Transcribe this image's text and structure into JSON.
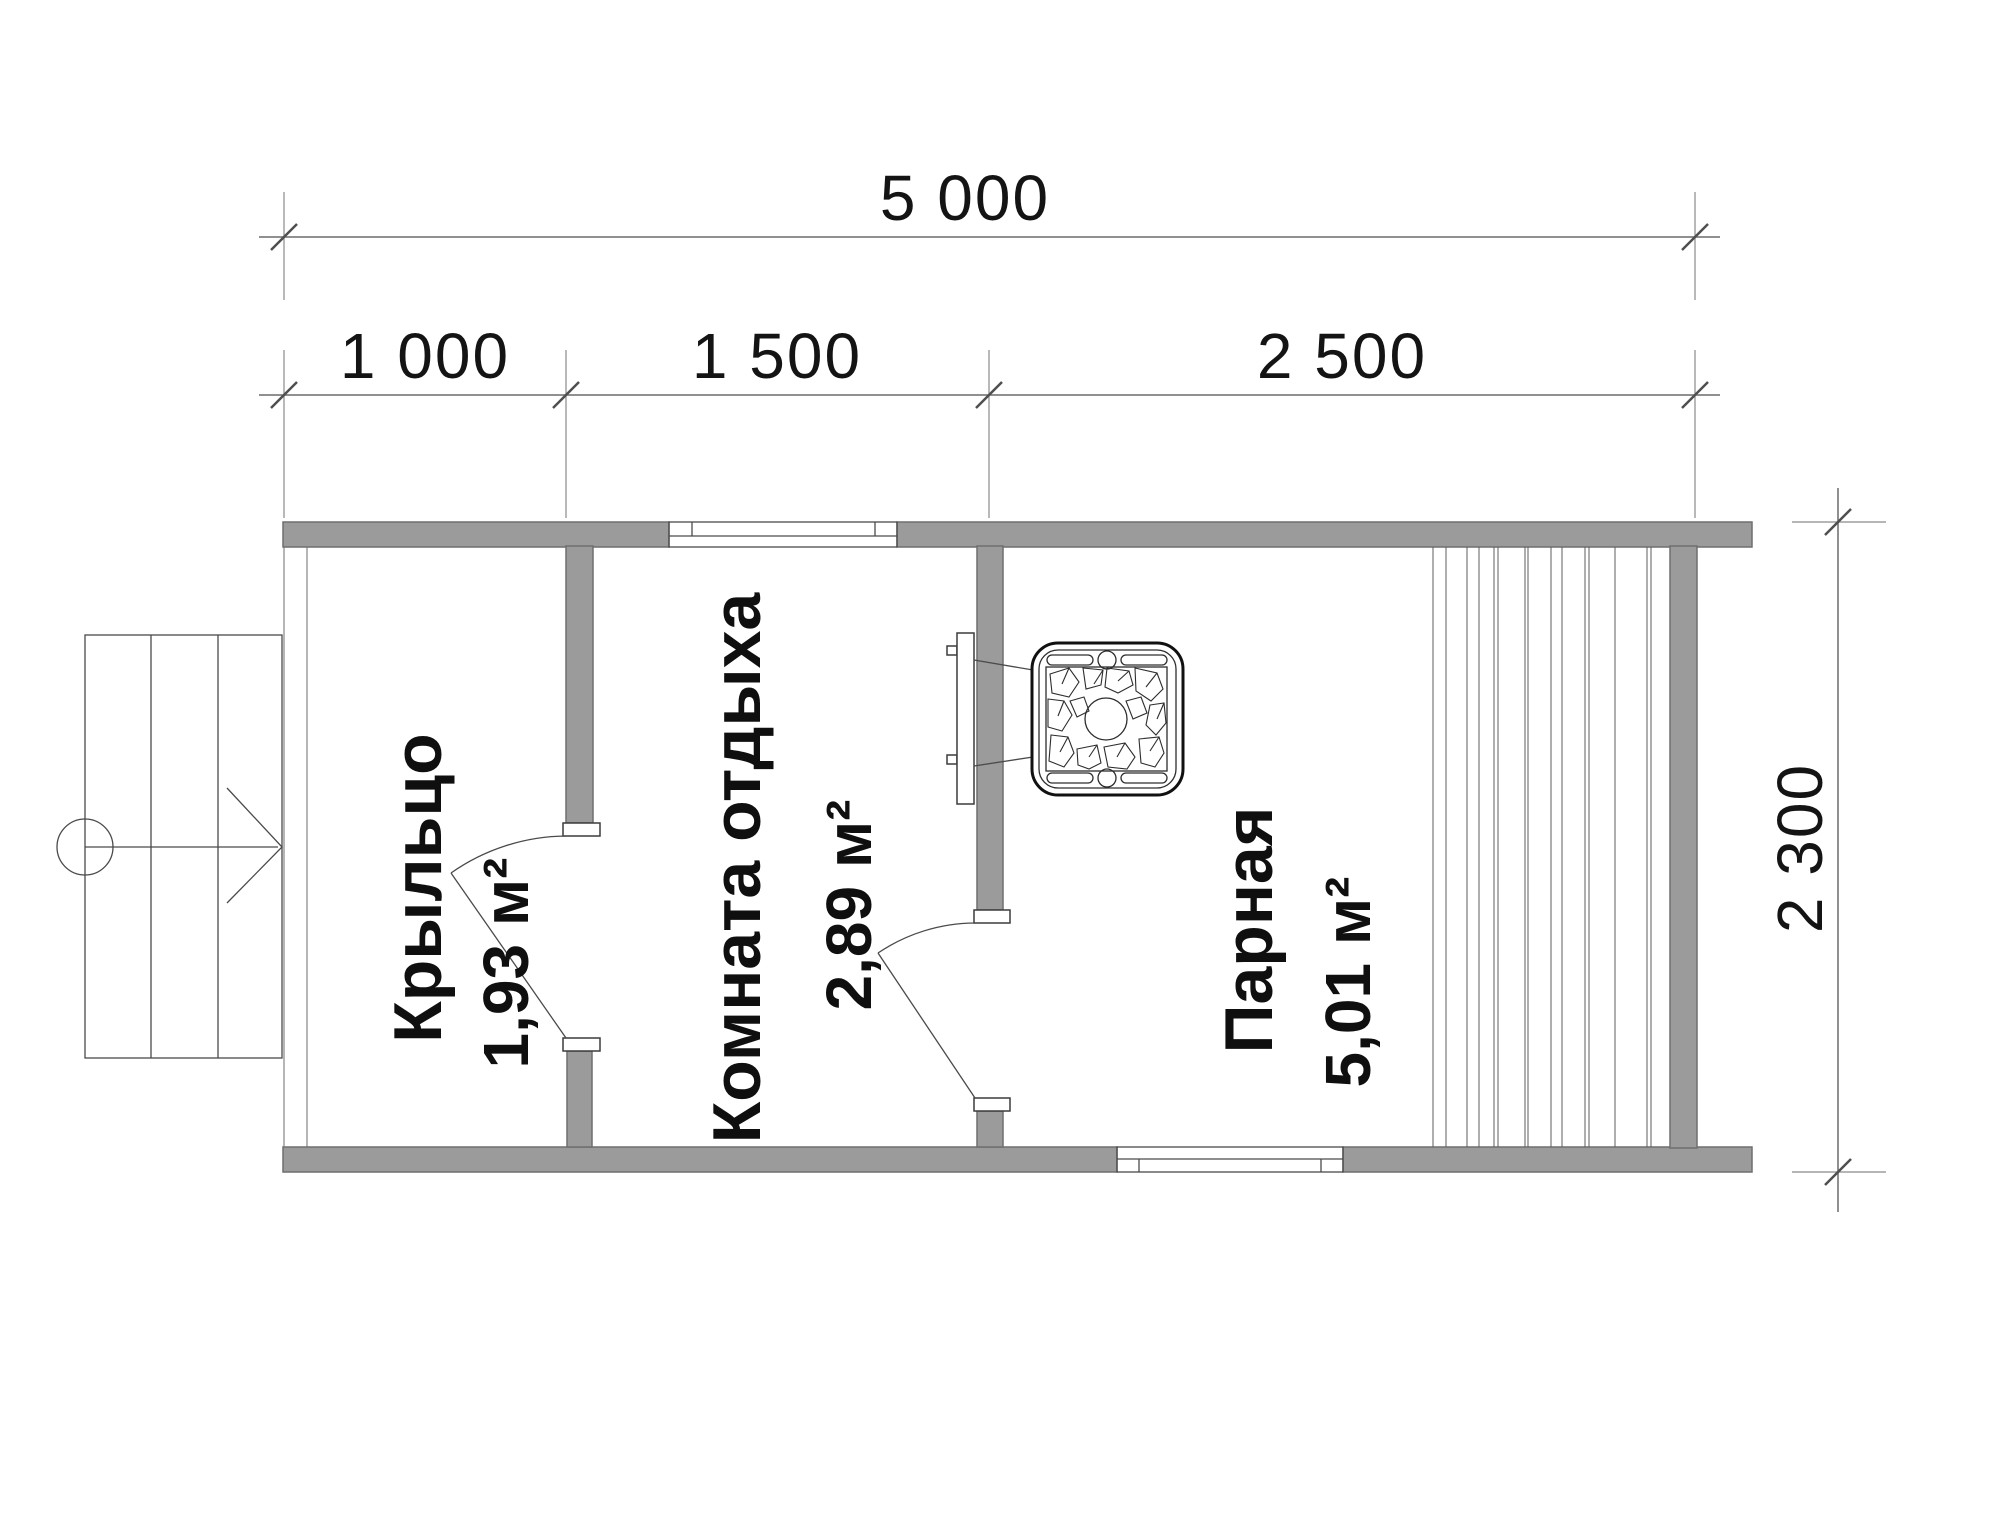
{
  "drawing": {
    "type": "floor-plan",
    "language": "ru"
  },
  "dimensions": {
    "total_width": "5 000",
    "segment_1": "1 000",
    "segment_2": "1 500",
    "segment_3": "2 500",
    "height": "2 300"
  },
  "rooms": {
    "porch": {
      "name": "Крыльцо",
      "area": "1,93 м²"
    },
    "rest": {
      "name": "Комната отдыха",
      "area": "2,89 м²"
    },
    "steam": {
      "name": "Парная",
      "area": "5,01 м²"
    }
  },
  "icons": {
    "stove": "stove-with-stones",
    "entrance_arrow": "entry-direction-arrow",
    "stairs": "porch-steps"
  },
  "colors": {
    "wall_fill": "#9b9b9b",
    "wall_edge": "#6f6f6f",
    "dim_line": "#6b6b6b",
    "text": "#141414",
    "background": "#ffffff"
  }
}
